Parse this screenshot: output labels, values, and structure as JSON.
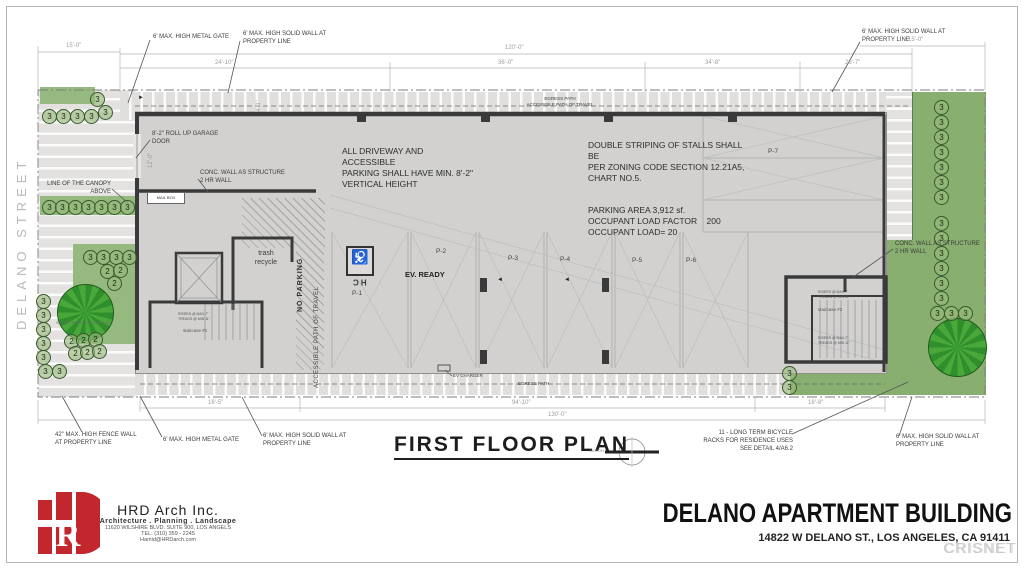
{
  "sheet": {
    "plan_title": "FIRST FLOOR PLAN",
    "north_label": "NORTH",
    "watermark": "CRISNET",
    "street_name": "DELANO STREET"
  },
  "notes": {
    "driveway": "ALL DRIVEWAY AND ACCESSIBLE\nPARKING SHALL HAVE MIN. 8'-2\"\nVERTICAL HEIGHT",
    "striping": "DOUBLE STRIPING OF STALLS SHALL BE\nPER ZONING CODE SECTION 12.21A5,\nCHART NO.5.",
    "parking_area": "PARKING AREA 3,912 sf.\nOCCUPANT LOAD FACTOR    200\nOCCUPANT LOAD= 20",
    "bike_rack": "11 - LONG TERM BICYCLE\nRACKS FOR RESIDENCE USES\nSEE DETAIL 4/A6.2",
    "short_bike_rack": "SHORT TERM BICYCLE RACK"
  },
  "annotations": {
    "metal_gate_top": "6' MAX. HIGH METAL GATE",
    "solid_wall_top": "6' MAX. HIGH SOLID WALL AT\nPROPERTY LINE",
    "solid_wall_top_right": "6' MAX. HIGH SOLID WALL AT\nPROPERTY LINE",
    "garage_door": "8'-2\" ROLL UP GARAGE\nDOOR",
    "conc_wall_left": "CONC. WALL AS STRUCTURE\n2 HR WALL",
    "conc_wall_right": "CONC. WALL AS STRUCTURE\n2 HR WALL",
    "canopy": "LINE OF THE CANOPY\nABOVE",
    "fence_wall_bottom": "42\" MAX. HIGH FENCE WALL\nAT PROPERTY LINE",
    "metal_gate_bottom": "6' MAX. HIGH METAL GATE",
    "solid_wall_bottom": "6' MAX. HIGH SOLID WALL AT\nPROPERTY LINE",
    "solid_wall_bottom_right": "6' MAX. HIGH SOLID WALL AT\nPROPERTY LINE"
  },
  "plan_labels": {
    "egress_top": "EGRESS PATH\nACCESSIBLE PATH OF TRAVEL",
    "egress_bottom": "EGRESS PATH",
    "ev_ready": "EV. READY",
    "ev_charger": "EV CHARGER",
    "no_parking": "NO PARKING",
    "accessible_path": "ACCESSIBLE PATH OF TRAVEL",
    "trash": "trash\nrecycle",
    "mail_box": "MAIL BOX",
    "stair1": "staircase #1",
    "stair2": "staircase #2",
    "stair_note": "RISERS @ MAX 7\"\nTREADS @ MIN 11\"",
    "hc": "HC",
    "wheelchair": "♿",
    "marker_three": "3",
    "marker_two": "2"
  },
  "stalls": {
    "p1": "P-1",
    "p2": "P-2",
    "p3": "P-3",
    "p4": "P-4",
    "p5": "P-5",
    "p6": "P-6",
    "p7": "P-7"
  },
  "dimensions": {
    "top_left": "15'-0\"",
    "overall_top": "120'-0\"",
    "seg1": "24'-10\"",
    "seg2": "36'-0\"",
    "seg3": "34'-8\"",
    "seg4": "26'-7\"",
    "top_right": "15'-0\"",
    "door_width": "12'-0\"",
    "walk_width": "4'-1\"",
    "bottom_left": "16'-5\"",
    "bottom_mid": "94'-10\"",
    "bottom_right": "18'-8\"",
    "overall_bottom": "130'-0\""
  },
  "firm": {
    "name": "HRD Arch Inc.",
    "tagline": "Architecture . Planning . Landscape",
    "address": "11620 WILSHIRE BLVD. SUITE 900, LOS ANGELS",
    "tel": "TEL: (310) 359 - 2245",
    "email": "Hamid@HRDarch.com"
  },
  "project": {
    "title": "DELANO APARTMENT BUILDING",
    "address": "14822 W DELANO ST., LOS ANGELES, CA 91411"
  }
}
